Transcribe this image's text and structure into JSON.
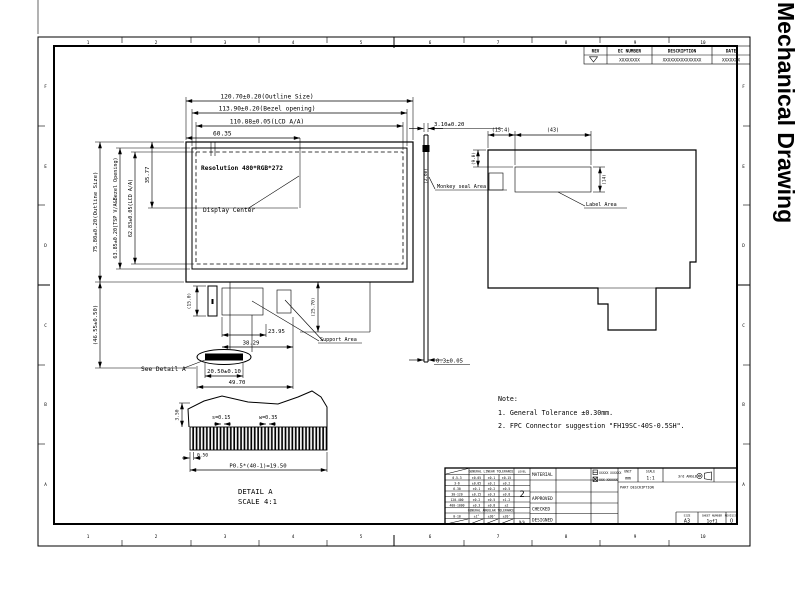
{
  "sheet": {
    "vertical_title": "Mechanical Drawing",
    "zones_h": [
      "1",
      "2",
      "3",
      "4",
      "5",
      "6",
      "7",
      "8",
      "9",
      "10"
    ],
    "zones_v": [
      "F",
      "E",
      "D",
      "C",
      "B",
      "A"
    ]
  },
  "revision_table": {
    "headers": [
      "REV",
      "EC NUMBER",
      "DESCRIPTION",
      "DATE"
    ],
    "row": {
      "ec_number": "XXXXXXXX",
      "description": "XXXXXXXXXXXXXXX",
      "date": "XXXXXXX"
    }
  },
  "front_view": {
    "dim_outline_width": "120.70±0.20(Outline Size)",
    "dim_bezel_width": "113.90±0.20(Bezel opening)",
    "dim_lcd_width": "110.88±0.05(LCD A/A)",
    "dim_center_x": "60.35",
    "dim_outline_height": "75.80±0.20(Outline Size)",
    "dim_bezel_height": "63.85±0.20(TSP V/A&Bezel Opening)",
    "dim_lcd_height": "62.83±0.05(LCD A/A)",
    "dim_center_y": "35.77",
    "dim_bottom_height": "(46.55±0.50)",
    "resolution_text": "Resolution 480*RGB*272",
    "display_center_label": "Display Center",
    "dim_tape": "(15.0)",
    "dim_fpc_drop": "(25.70)",
    "dim_pad_offset": "23.95",
    "dim_pads_span": "38.29",
    "dim_contact_width": "20.50±0.10",
    "dim_fpc_width": "49.70",
    "support_area_label": "Support Area",
    "see_detail_label": "See Detail A"
  },
  "side_view": {
    "dim_thickness": "3.10±0.20",
    "dim_glass": "(2.60)",
    "seal_label": "Monkey seal Area",
    "dim_step": "0.3±0.05"
  },
  "back_view": {
    "dim_seal_offset": "(15.4)",
    "dim_label_width": "(43)",
    "dim_label_top": "(9.0)",
    "dim_label_height": "(14)",
    "label_area_label": "Label Area"
  },
  "notes": {
    "heading": "Note:",
    "line1": "1. General Tolerance ±0.30mm.",
    "line2": "2. FPC Connector suggestion  \"FH19SC-40S-0.5SH\"."
  },
  "detail_a": {
    "title": "DETAIL  A",
    "scale": "SCALE  4:1",
    "dim_finger_len": "3.50",
    "dim_space": "s=0.15",
    "dim_width": "w=0.35",
    "dim_margin": "0.50",
    "dim_pitch": "P0.5*(40-1)=19.50"
  },
  "title_block": {
    "linear_header": "GENERAL LINEAR TOLERANCE",
    "angular_header": "GENERAL ANGULAR TOLERANCE",
    "level_label": "LEVEL",
    "grade": "2",
    "tol_rows": [
      [
        "0.5-3",
        "±0.05",
        "±0.1",
        "±0.15"
      ],
      [
        "3-6",
        "±0.05",
        "±0.1",
        "±0.2"
      ],
      [
        "6-30",
        "±0.1",
        "±0.2",
        "±0.5"
      ],
      [
        "30-120",
        "±0.15",
        "±0.3",
        "±0.8"
      ],
      [
        "120-400",
        "±0.2",
        "±0.5",
        "±1.2"
      ],
      [
        "400-1000",
        "±0.3",
        "±0.8",
        "±2"
      ]
    ],
    "ang_row": [
      "0-10",
      "±1°",
      "±30'",
      "±20'"
    ],
    "na": "N/A",
    "material_label": "MATERIAL",
    "approved_label": "APPROVED",
    "checked_label": "CHECKED",
    "designed_label": "DESIGNED",
    "check1": "XXXXX XXXXXX",
    "check2": "XXX XXXXXX",
    "unit_label": "UNIT",
    "unit_value": "mm",
    "scale_label": "SCALE",
    "scale_value": "1:1",
    "angle_label": "3rd ANGLE",
    "part_desc_label": "PART DESCRIPTION",
    "size_label": "SIZE",
    "size_value": "A3",
    "sheet_label": "SHEET NUMBER",
    "sheet_value": "1of1",
    "revision_label": "REVISION",
    "revision_value": "O"
  }
}
